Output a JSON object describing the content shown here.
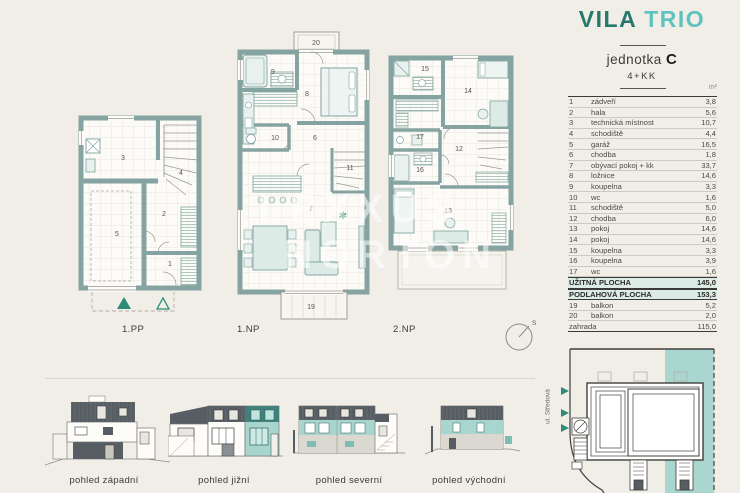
{
  "header": {
    "brand": {
      "word1": "VILA",
      "word2": "TRIO"
    },
    "unit_word": "jednotka",
    "unit_letter": "C",
    "disposition": "4+KK",
    "area_unit": "m²"
  },
  "table": {
    "rows": [
      {
        "num": "1",
        "label": "zádveří",
        "value": "3,8"
      },
      {
        "num": "2",
        "label": "hala",
        "value": "5,6"
      },
      {
        "num": "3",
        "label": "technická místnost",
        "value": "10,7"
      },
      {
        "num": "4",
        "label": "schodiště",
        "value": "4,4"
      },
      {
        "num": "5",
        "label": "garáž",
        "value": "16,5"
      },
      {
        "num": "6",
        "label": "chodba",
        "value": "1,8"
      },
      {
        "num": "7",
        "label": "obývací pokoj + kk",
        "value": "33,7"
      },
      {
        "num": "8",
        "label": "ložnice",
        "value": "14,6"
      },
      {
        "num": "9",
        "label": "koupelna",
        "value": "3,3"
      },
      {
        "num": "10",
        "label": "wc",
        "value": "1,6"
      },
      {
        "num": "11",
        "label": "schodiště",
        "value": "5,0"
      },
      {
        "num": "12",
        "label": "chodba",
        "value": "6,0"
      },
      {
        "num": "13",
        "label": "pokoj",
        "value": "14,6"
      },
      {
        "num": "14",
        "label": "pokoj",
        "value": "14,6"
      },
      {
        "num": "15",
        "label": "koupelna",
        "value": "3,3"
      },
      {
        "num": "16",
        "label": "koupelna",
        "value": "3,9"
      },
      {
        "num": "17",
        "label": "wc",
        "value": "1,6"
      },
      {
        "num": "",
        "label": "UŽITNÁ PLOCHA",
        "value": "145,0",
        "type": "sum"
      },
      {
        "num": "",
        "label": "PODLAHOVÁ PLOCHA",
        "value": "153,3",
        "type": "sum"
      },
      {
        "num": "19",
        "label": "balkon",
        "value": "5,2"
      },
      {
        "num": "20",
        "label": "balkon",
        "value": "2,0"
      },
      {
        "num": "",
        "label": "zahrada",
        "value": "115,0"
      }
    ]
  },
  "plans": {
    "pp": {
      "label": "1.PP",
      "rooms": [
        "1",
        "2",
        "3",
        "4",
        "5"
      ]
    },
    "np1": {
      "label": "1.NP",
      "rooms": [
        "6",
        "7",
        "8",
        "9",
        "10",
        "11",
        "19",
        "20"
      ]
    },
    "np2": {
      "label": "2.NP",
      "rooms": [
        "12",
        "13",
        "14",
        "15",
        "16",
        "17"
      ]
    }
  },
  "elevations": [
    "pohled západní",
    "pohled jižní",
    "pohled severní",
    "pohled východní"
  ],
  "site": {
    "street": "ul. Středová"
  },
  "compass": {
    "north": "S"
  },
  "watermark": {
    "line1": "LEXXUS",
    "line2": "NORTON"
  },
  "colors": {
    "background": "#f1eee8",
    "wall": "#85a3a1",
    "accent_dark": "#27796d",
    "accent_light": "#5ec3be",
    "highlight": "#a9d6ce",
    "summary_bg": "#dcebe5",
    "entrance_marker": "#2e8b77"
  }
}
